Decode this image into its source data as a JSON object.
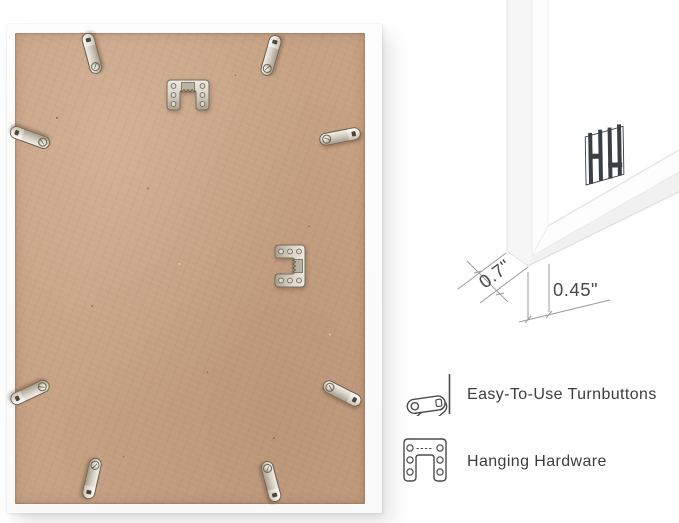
{
  "annotations": {
    "dimension_side_label": "0.7\"",
    "dimension_face_label": "0.45\"",
    "features": [
      {
        "icon": "turnbutton-icon",
        "label": "Easy-To-Use Turnbuttons"
      },
      {
        "icon": "hanging-hardware-icon",
        "label": "Hanging Hardware"
      }
    ]
  },
  "colors": {
    "background": "#ffffff",
    "backing_board": "#c6a183",
    "frame_white": "#fcfcfc",
    "metal_silver": "#d6d0c4",
    "logo_mark": "#3a3f45",
    "annotation_text": "#4a4a4a",
    "feature_text": "#3d3d3d"
  }
}
